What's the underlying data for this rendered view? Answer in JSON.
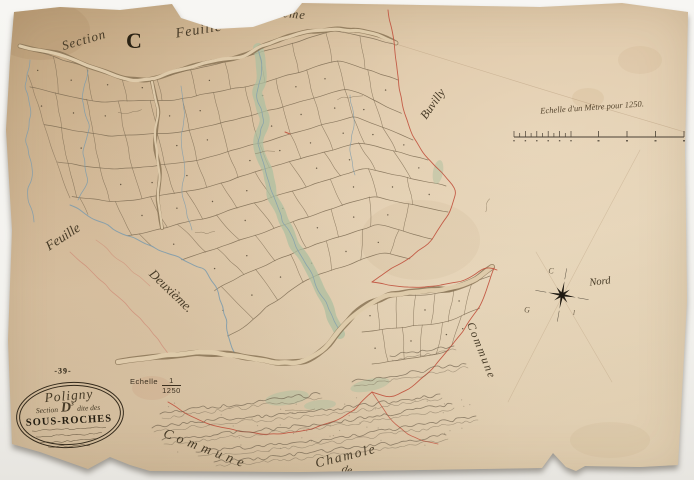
{
  "labels": {
    "section_script": "Section",
    "section_letter": "C",
    "feuille_top": "Feuille",
    "deuxieme_top": "Deuxième",
    "feuille_left": "Feuille",
    "deuxieme_left": "Deuxième.",
    "neighbor_commune": "Buvilly",
    "commune_side": "Commune",
    "commune_bottom": "Commune",
    "commune_bottom_de": "de",
    "commune_bottom_name": "Chamole"
  },
  "scale": {
    "caption": "Echelle d'un Mètre pour 1250.",
    "label": "Echelle",
    "numerator": "1",
    "denominator": "1250"
  },
  "compass": {
    "north": "Nord",
    "mark_top": "C",
    "mark_left": "G",
    "mark_bottom": "l"
  },
  "cartouche": {
    "dept": "-39-",
    "commune": "Poligny",
    "section_pre": "Section",
    "section_letter": "D",
    "section_exp": "3",
    "section_post": "dite des",
    "title": "SOUS-ROCHES",
    "sheet": "12"
  },
  "colors": {
    "ink": "#453826",
    "parcel_line": "#7d6b52",
    "road_edge": "#8a7456",
    "road_fill": "#e2cfae",
    "stream": "#7f9cac",
    "green": "#aebfa0",
    "red": "#c0503c",
    "pink": "#cc7766",
    "hachure": "#6d604c",
    "faint": "#b49878"
  }
}
